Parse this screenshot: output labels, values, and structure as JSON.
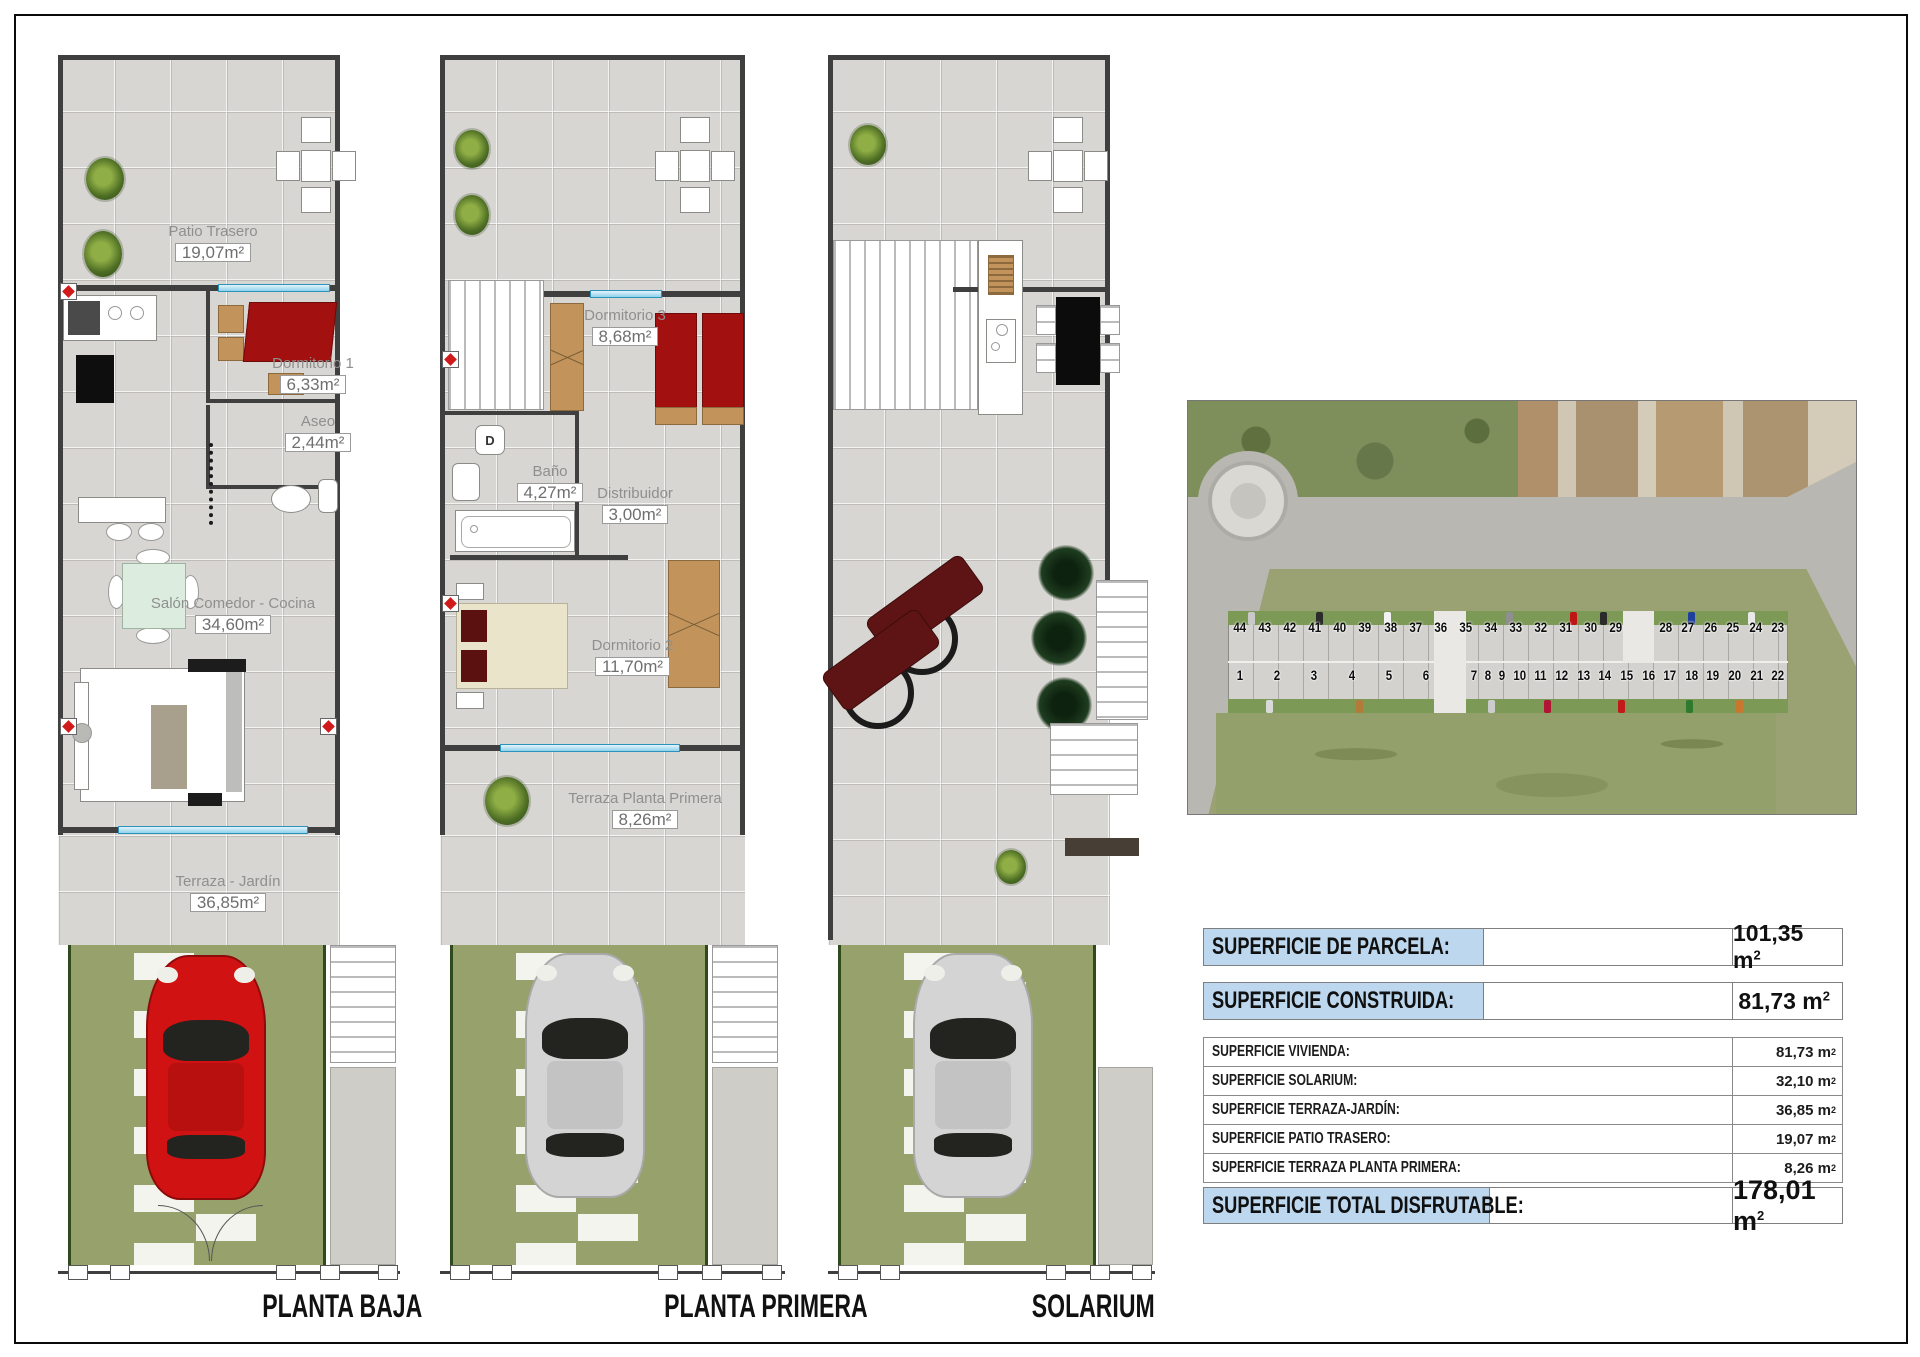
{
  "document": {
    "captions": {
      "plan1": "PLANTA BAJA",
      "plan2": "PLANTA PRIMERA",
      "plan3": "SOLARIUM"
    }
  },
  "rooms": {
    "patio_trasero": {
      "label": "Patio Trasero",
      "area": "19,07m²"
    },
    "dormitorio1": {
      "label": "Dormitorio 1",
      "area": "6,33m²"
    },
    "aseo": {
      "label": "Aseo",
      "area": "2,44m²"
    },
    "salon": {
      "label": "Salón Comedor - Cocina",
      "area": "34,60m²"
    },
    "terraza_jardin": {
      "label": "Terraza - Jardín",
      "area": "36,85m²"
    },
    "dormitorio3": {
      "label": "Dormitorio 3",
      "area": "8,68m²"
    },
    "bano": {
      "label": "Baño",
      "area": "4,27m²"
    },
    "distribuidor": {
      "label": "Distribuidor",
      "area": "3,00m²"
    },
    "dormitorio2": {
      "label": "Dormitorio 2",
      "area": "11,70m²"
    },
    "terraza_primera": {
      "label": "Terraza Planta Primera",
      "area": "8,26m²"
    }
  },
  "fixtures": {
    "washer": "D"
  },
  "summary": {
    "highlight_color": "#bdd7ee",
    "primary": [
      {
        "label": "SUPERFICIE DE PARCELA:",
        "value": "101,35 m",
        "sup": "2"
      },
      {
        "label": "SUPERFICIE CONSTRUIDA:",
        "value": "81,73 m",
        "sup": "2"
      }
    ],
    "details": [
      {
        "label": "SUPERFICIE VIVIENDA:",
        "value": "81,73 m",
        "sup": "2"
      },
      {
        "label": "SUPERFICIE SOLARIUM:",
        "value": "32,10 m",
        "sup": "2"
      },
      {
        "label": "SUPERFICIE TERRAZA-JARDÍN:",
        "value": "36,85 m",
        "sup": "2"
      },
      {
        "label": "SUPERFICIE PATIO TRASERO:",
        "value": "19,07 m",
        "sup": "2"
      },
      {
        "label": "SUPERFICIE TERRAZA PLANTA PRIMERA:",
        "value": "8,26 m",
        "sup": "2"
      }
    ],
    "total": {
      "label": "SUPERFICIE TOTAL DISFRUTABLE:",
      "value": "178,01 m",
      "sup": "2"
    }
  },
  "aerial": {
    "plots_top_left": [
      "44",
      "43",
      "42",
      "41",
      "40",
      "39",
      "38",
      "37",
      "36",
      "35",
      "34",
      "33",
      "32",
      "31",
      "30",
      "29"
    ],
    "plots_top_right": [
      "28",
      "27",
      "26",
      "25",
      "24",
      "23"
    ],
    "plots_bottom_left": [
      "1",
      "2",
      "3",
      "4",
      "5",
      "6"
    ],
    "plots_bottom_right": [
      "7",
      "8",
      "9",
      "10",
      "11",
      "12",
      "13",
      "14",
      "15",
      "16",
      "17",
      "18",
      "19",
      "20",
      "21",
      "22"
    ]
  }
}
